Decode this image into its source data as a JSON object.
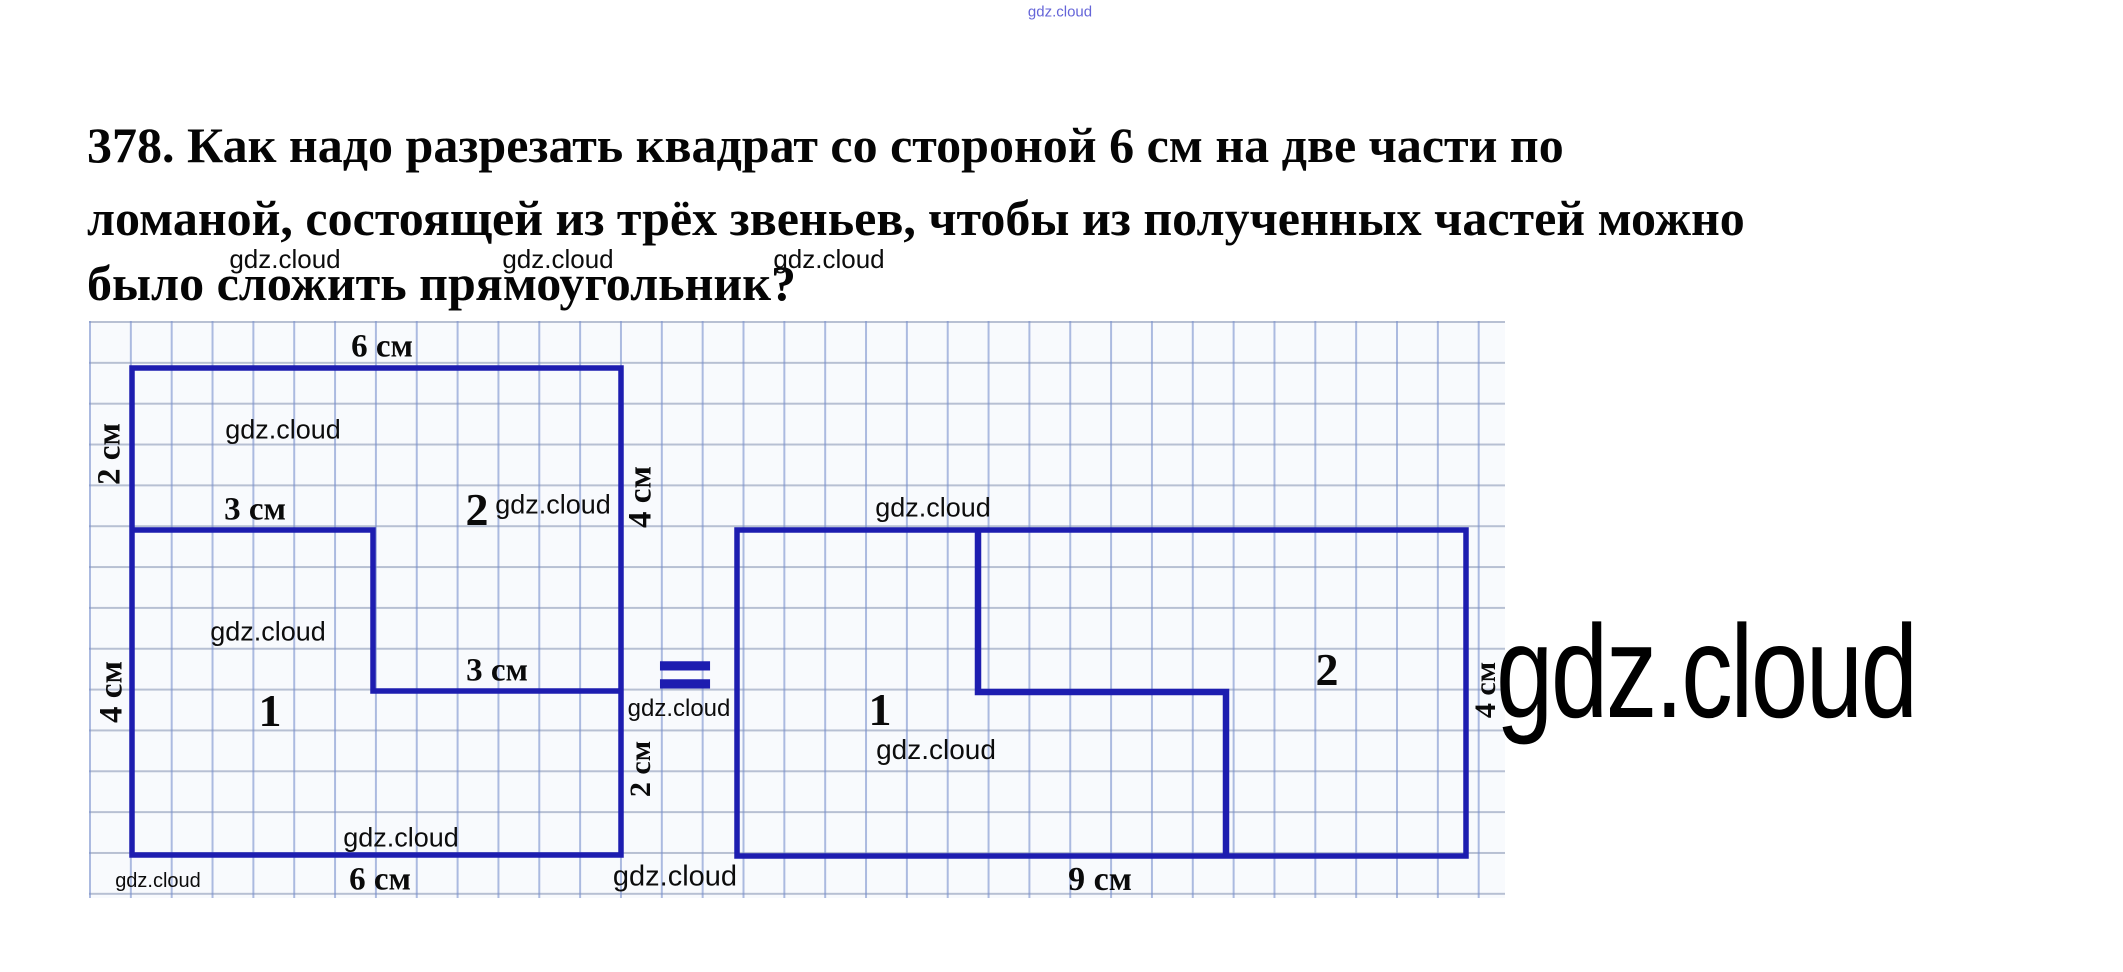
{
  "watermark": "gdz.cloud",
  "page": {
    "text_line1": "378. Как надо разрезать квадрат со стороной 6 см на две части по",
    "text_line2": "ломаной, состоящей из трёх звеньев, чтобы из полученных частей можно",
    "text_line3": "было сложить прямоугольник?"
  },
  "figure": {
    "equals_sign": "=",
    "square": {
      "side_cm": 6,
      "top_label": "6 см",
      "bottom_label": "6 см",
      "left_top_label": "2 см",
      "left_bottom_label": "4 см",
      "right_top_label": "4 см",
      "right_bottom_label": "2 см",
      "cut_upper_label": "3 см",
      "cut_lower_label": "3 см",
      "piece1_label": "1",
      "piece2_label": "2"
    },
    "rectangle": {
      "width_cm": 9,
      "height_cm": 4,
      "bottom_label": "9 см",
      "right_label": "4 см",
      "piece1_label": "1",
      "piece2_label": "2"
    }
  },
  "colors": {
    "figure_line": "#1d1db0",
    "grid_line_vertical": "#7f8fcc",
    "grid_line_horizontal": "#8290b0",
    "grid_background": "#f8fafd",
    "text": "#050505",
    "top_watermark": "#4a4ad2"
  }
}
